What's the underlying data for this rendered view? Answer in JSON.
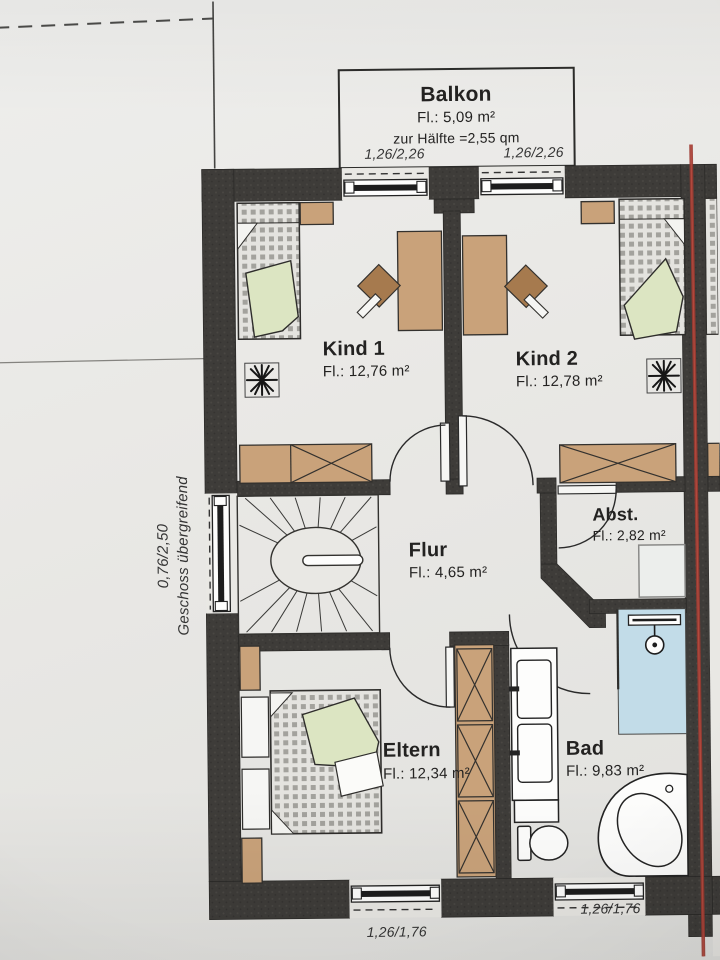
{
  "balcony": {
    "name": "Balkon",
    "area": "Fl.: 5,09 m²",
    "note": "zur Hälfte =2,55 qm"
  },
  "rooms": {
    "kind1": {
      "name": "Kind 1",
      "area": "Fl.: 12,76 m²"
    },
    "kind2": {
      "name": "Kind 2",
      "area": "Fl.: 12,78 m²"
    },
    "flur": {
      "name": "Flur",
      "area": "Fl.: 4,65 m²"
    },
    "abst": {
      "name": "Abst.",
      "area": "Fl.: 2,82 m²"
    },
    "eltern": {
      "name": "Eltern",
      "area": "Fl.: 12,34 m²"
    },
    "bad": {
      "name": "Bad",
      "area": "Fl.: 9,83 m²"
    }
  },
  "dimensions": {
    "balcony_window_left": "1,26/2,26",
    "balcony_window_right": "1,26/2,26",
    "bottom_window_left": "1,26/1,76",
    "bottom_window_right": "1,26/1,76",
    "side_window": "0,76/2,50",
    "side_window_note": "Geschoss übergreifend"
  },
  "colors": {
    "paper": "#e9e8e4",
    "wall": "#3e3c39",
    "wood": "#c9a27a",
    "wood_dark": "#a67a4e",
    "blanket": "#dce5c2",
    "shower": "#c2dce8",
    "red_line": "#9c3a31"
  }
}
